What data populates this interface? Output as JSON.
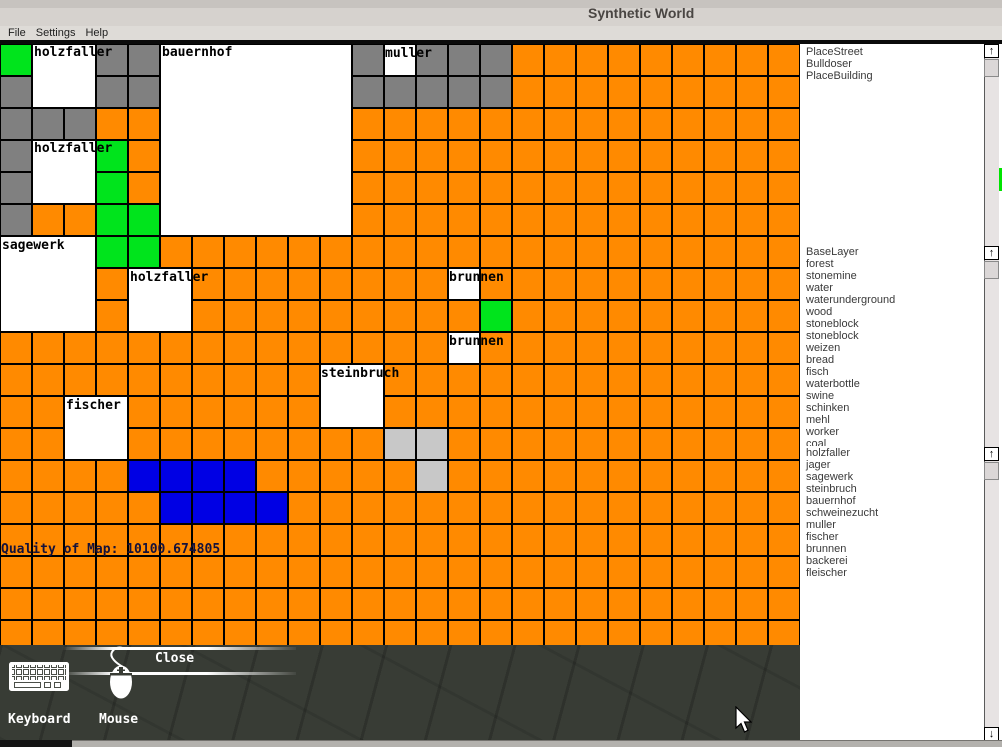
{
  "window": {
    "title": "Synthetic World"
  },
  "menu": {
    "items": [
      "File",
      "Settings",
      "Help"
    ]
  },
  "map": {
    "cell_size": 32,
    "cell_colors": {
      "O": "#ff8a00",
      "G": "#808080",
      "N": "#00e41c",
      "B": "#0000e4",
      "L": "#c8c8c8"
    },
    "rows": [
      "N..GG......G.GGGOOOOOOOOO",
      "G..GG......GGGGGOOOOOOOOO",
      "GGGOO......OOOOOOOOOOOOOO",
      "G..NO......OOOOOOOOOOOOOO",
      "G..NO......OOOOOOOOOOOOOO",
      "GOONN......OOOOOOOOOOOOOO",
      "...NNOOOOOOOOOOOOOOOOOOOO",
      "...O..OOOOOOOO.OOOOOOOOOO",
      "...O..OOOOOOOOONOOOOOOOOO",
      "OOOOOOOOOOOOOO.OOOOOOOOOO",
      "OOOOOOOOOO..OOOOOOOOOOOOO",
      "OO..OOOOOO..OOOOOOOOOOOOO",
      "OO..OOOOOOOOLLOOOOOOOOOOO",
      "OOOOBBBBOOOOOLOOOOOOOOOOO",
      "OOOOOBBBBOOOOOOOOOOOOOOOO",
      "OOOOOOOOOOOOOOOOOOOOOOOOO",
      "OOOOOOOOOOOOOOOOOOOOOOOOO",
      "OOOOOOOOOOOOOOOOOOOOOOOOO",
      "OOOOOOOOOOOOOOOOOOOOOOOOO"
    ],
    "buildings": [
      {
        "name": "holzfaller",
        "col": 1,
        "row": 0,
        "w": 2,
        "h": 2
      },
      {
        "name": "bauernhof",
        "col": 5,
        "row": 0,
        "w": 6,
        "h": 6
      },
      {
        "name": "muller",
        "col": 12,
        "row": 0,
        "w": 1,
        "h": 1
      },
      {
        "name": "holzfaller",
        "col": 1,
        "row": 3,
        "w": 2,
        "h": 2
      },
      {
        "name": "sagewerk",
        "col": 0,
        "row": 6,
        "w": 3,
        "h": 3
      },
      {
        "name": "holzfaller",
        "col": 4,
        "row": 7,
        "w": 2,
        "h": 2
      },
      {
        "name": "brunnen",
        "col": 14,
        "row": 7,
        "w": 1,
        "h": 1
      },
      {
        "name": "brunnen",
        "col": 14,
        "row": 9,
        "w": 1,
        "h": 1
      },
      {
        "name": "steinbruch",
        "col": 10,
        "row": 10,
        "w": 2,
        "h": 2
      },
      {
        "name": "fischer",
        "col": 2,
        "row": 11,
        "w": 2,
        "h": 2
      }
    ],
    "labels": [
      {
        "text": "holzfaller",
        "x": 34,
        "y": 2
      },
      {
        "text": "bauernhof",
        "x": 162,
        "y": 2
      },
      {
        "text": "muller",
        "x": 385,
        "y": 3
      },
      {
        "text": "holzfaller",
        "x": 34,
        "y": 98
      },
      {
        "text": "sagewerk",
        "x": 2,
        "y": 195
      },
      {
        "text": "holzfaller",
        "x": 130,
        "y": 227
      },
      {
        "text": "brunnen",
        "x": 449,
        "y": 227
      },
      {
        "text": "brunnen",
        "x": 449,
        "y": 291
      },
      {
        "text": "steinbruch",
        "x": 321,
        "y": 323
      },
      {
        "text": "fischer",
        "x": 66,
        "y": 355
      }
    ],
    "quality_text": "Quality of Map: 10100.674805"
  },
  "panel": {
    "tools": [
      "PlaceStreet",
      "Bulldoser",
      "PlaceBuilding"
    ],
    "layers": [
      "BaseLayer",
      "forest",
      "stonemine",
      "water",
      "waterunderground",
      "wood",
      "stoneblock",
      "stoneblock",
      "weizen",
      "bread",
      "fisch",
      "waterbottle",
      "swine",
      "schinken",
      "mehl",
      "worker",
      "coal"
    ],
    "buildings": [
      "holzfaller",
      "jager",
      "sagewerk",
      "steinbruch",
      "bauernhof",
      "schweinezucht",
      "muller",
      "fischer",
      "brunnen",
      "backerei",
      "fleischer"
    ],
    "scroll_up_glyph": "↑",
    "scroll_down_glyph": "↓",
    "selection_marker_color": "#00e400"
  },
  "bottom": {
    "close_label": "Close",
    "keyboard_label": "Keyboard",
    "mouse_label": "Mouse"
  },
  "icons": {
    "keyboard_icon": "keyboard",
    "mouse_icon": "mouse",
    "cursor_icon": "arrow-cursor"
  }
}
